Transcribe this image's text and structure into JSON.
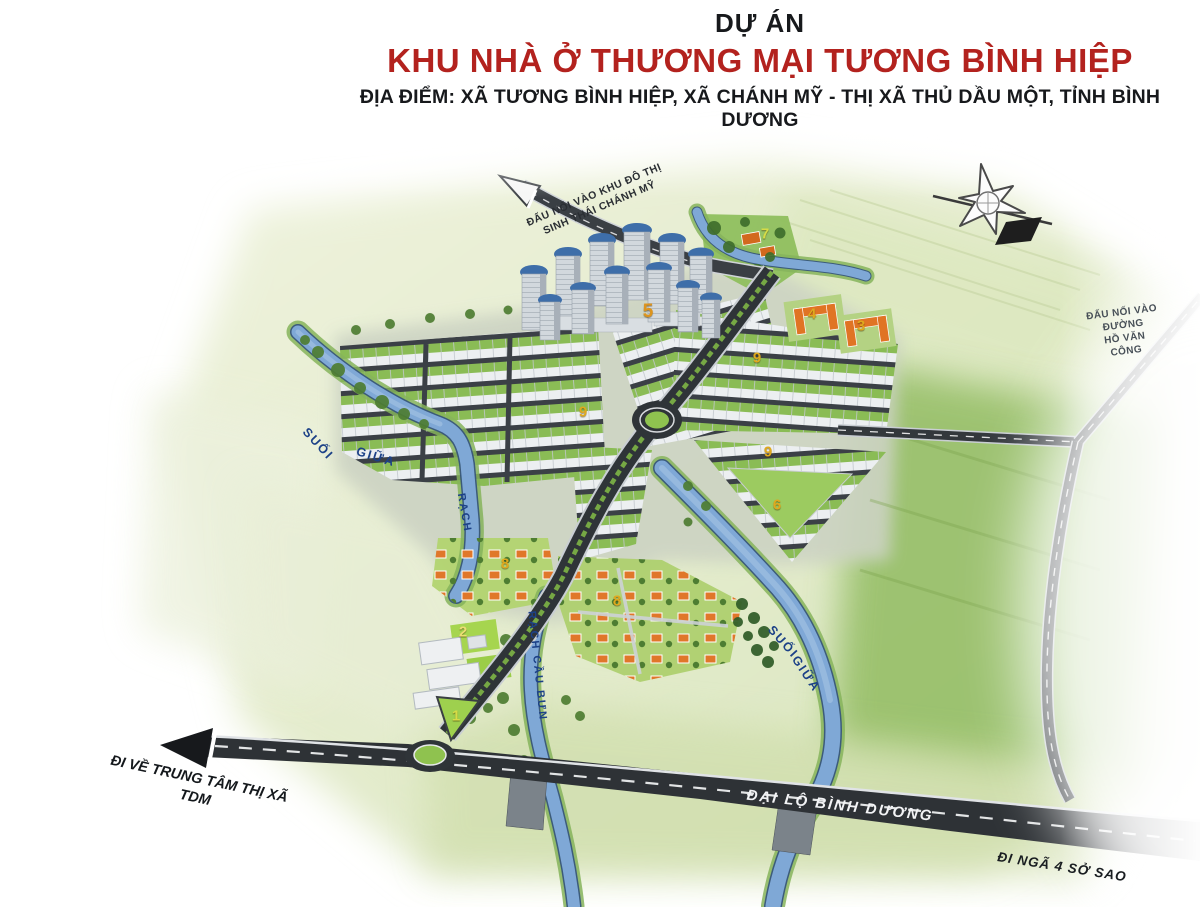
{
  "header": {
    "project_label": "DỰ ÁN",
    "title": "KHU NHÀ Ở THƯƠNG MẠI TƯƠNG BÌNH HIỆP",
    "location": "ĐỊA ĐIỂM:  XÃ TƯƠNG BÌNH HIỆP, XÃ CHÁNH MỸ - THỊ XÃ THỦ DẦU MỘT, TỈNH BÌNH DƯƠNG",
    "title_color": "#b3221e"
  },
  "map": {
    "road_labels": {
      "connector_chanh_my": "ĐẤU NỐI VÀO KHU ĐÔ THỊ\nSINH THÁI CHÁNH MỸ",
      "connector_ho_van_cong": "ĐẤU NỐI VÀO ĐƯỜNG\nHỒ VĂN CÔNG",
      "to_tdm": "ĐI VỀ TRUNG TÂM THỊ XÃ\nTDM",
      "dai_lo_binh_duong": "ĐẠI LỘ BÌNH DƯƠNG",
      "nga_4_so_sao": "ĐI NGÃ 4 SỞ SAO"
    },
    "river_labels": {
      "suoi_left": "SUỐI",
      "giua_left": "GIỮA",
      "rach": "RẠCH",
      "rach_cau_bun": "RẠCH CẦU BƯN",
      "suoi_right": "SUỐI",
      "giua_right": "GIỮA"
    },
    "lot_numbers": [
      "1",
      "2",
      "3",
      "4",
      "5",
      "6",
      "7",
      "8",
      "8",
      "9",
      "9",
      "9"
    ],
    "colors": {
      "title_red": "#b3221e",
      "water": "#7fa8d6",
      "road_dark": "#2f3438",
      "grass_green": "#8cb85e",
      "roof_green": "#8abc55",
      "villa_orange": "#e0772a",
      "number_gold": "#dfa91e"
    }
  }
}
